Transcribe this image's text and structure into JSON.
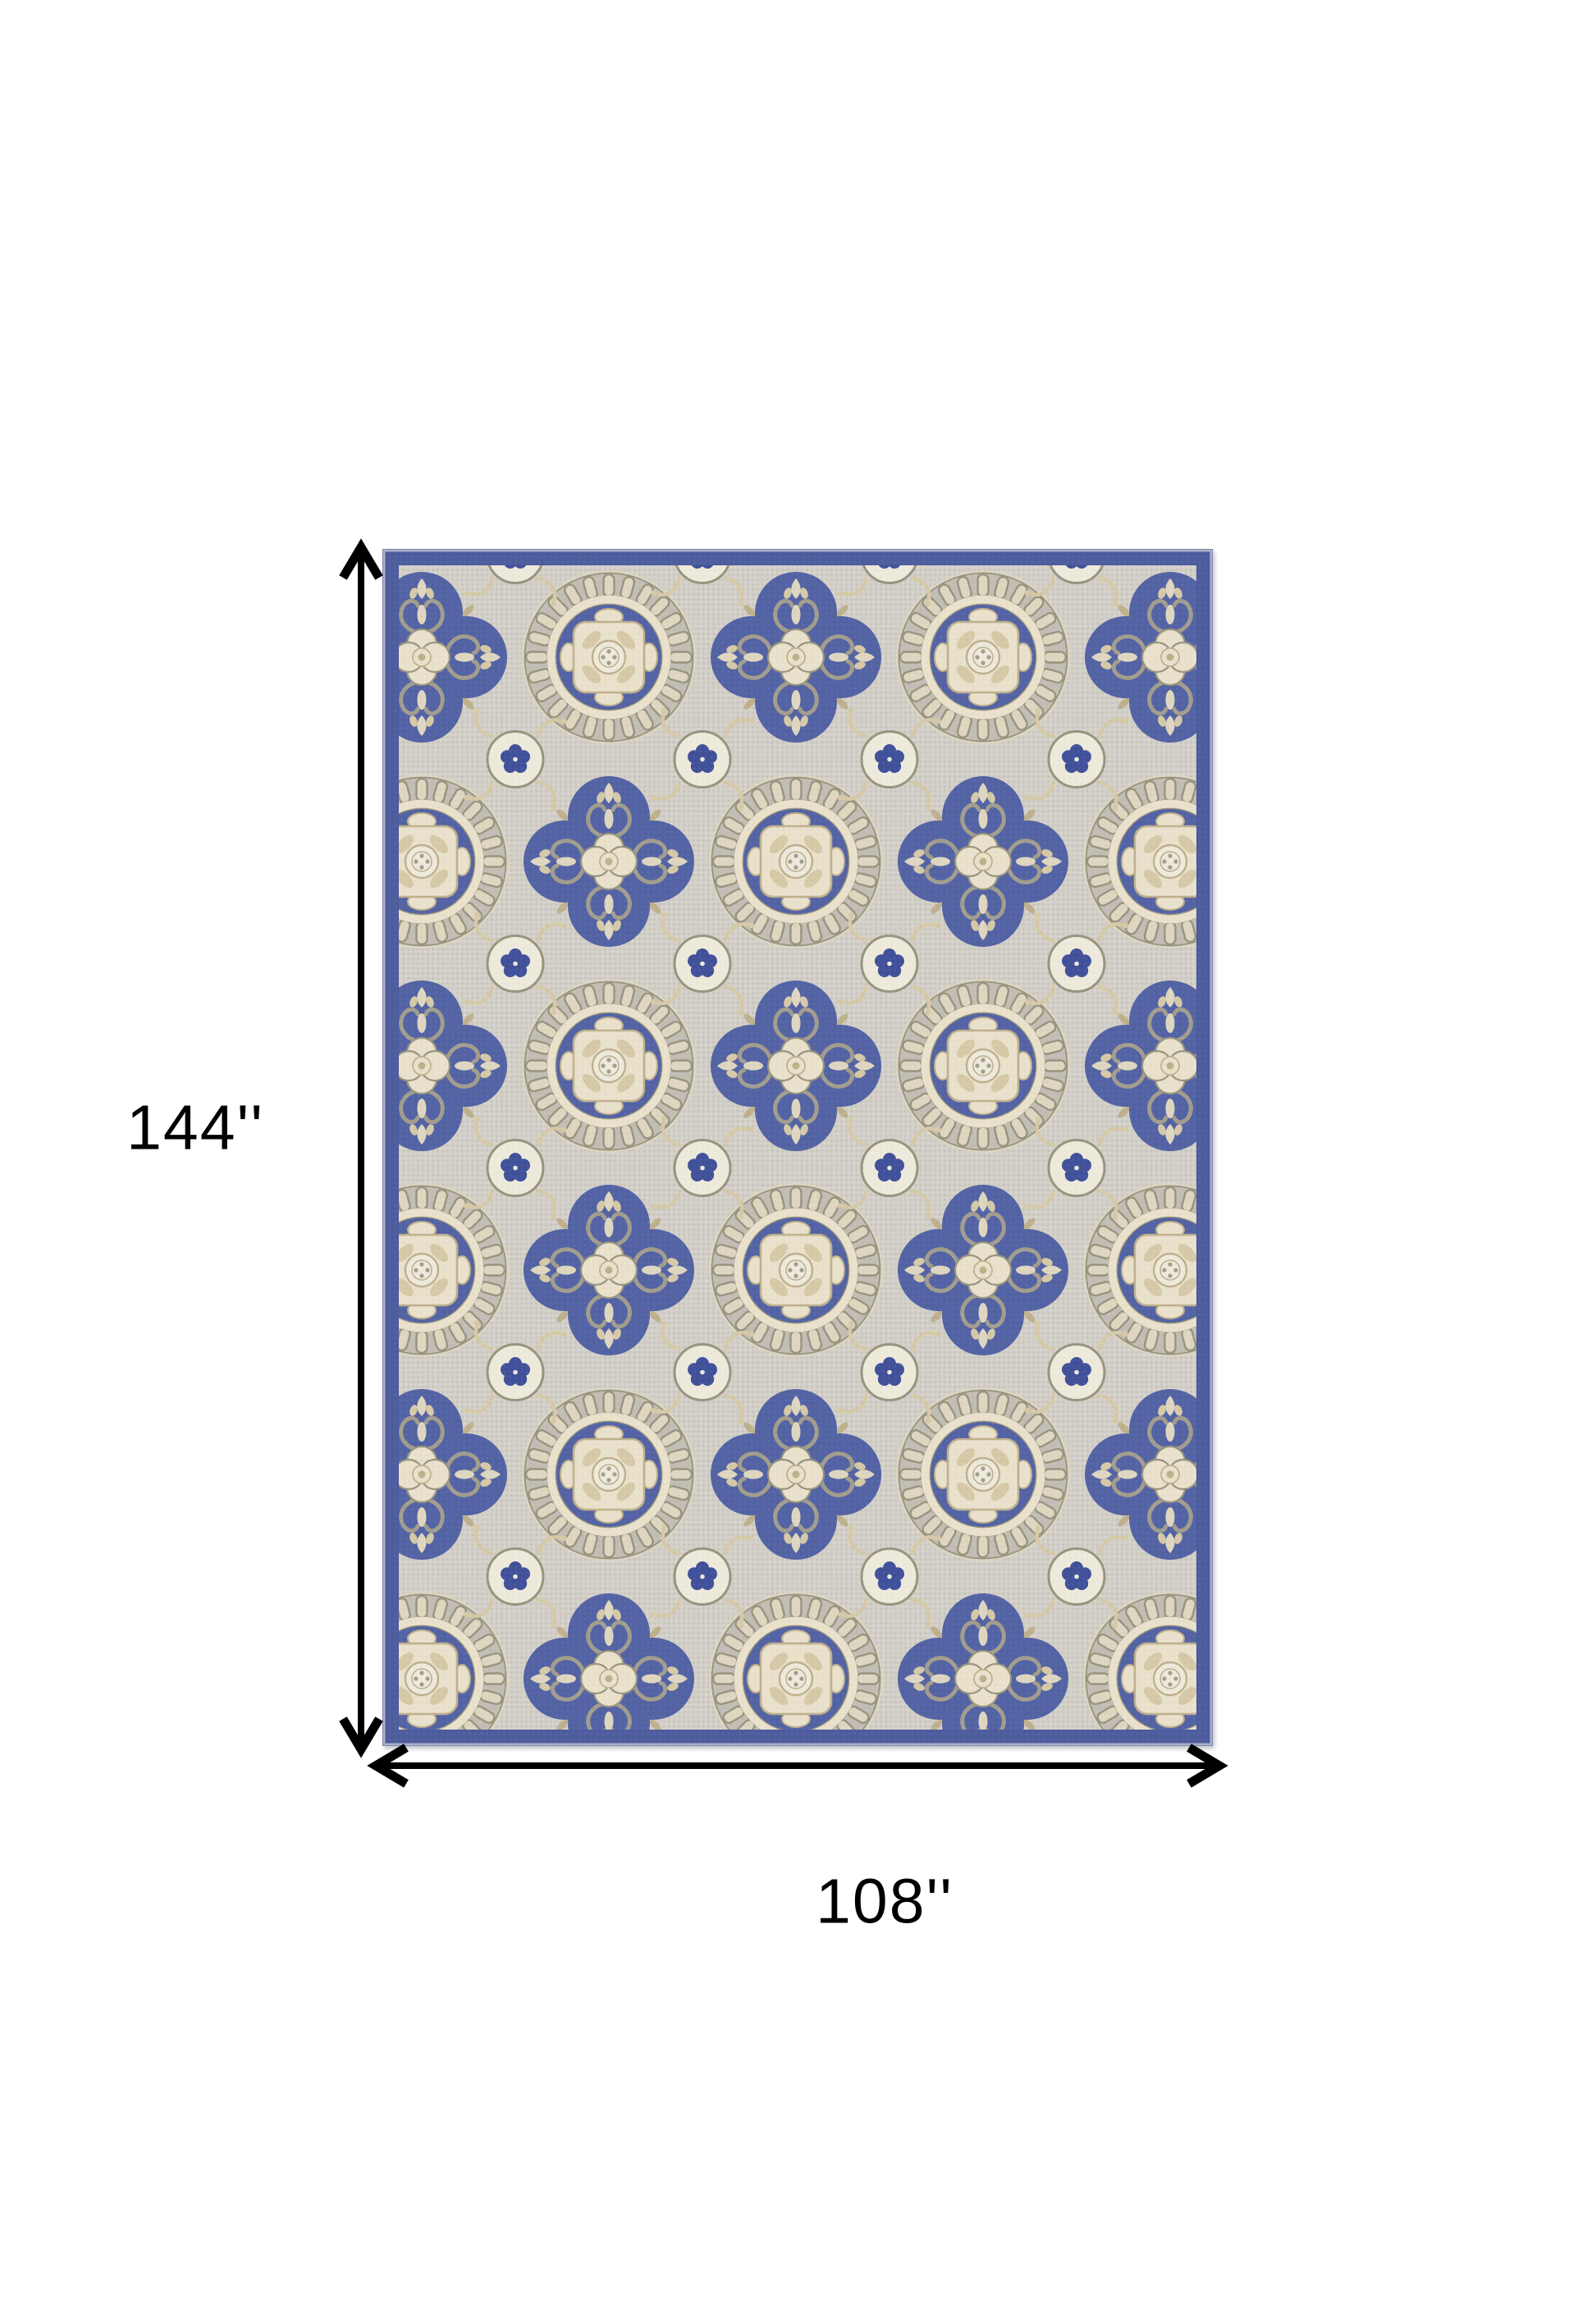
{
  "page": {
    "background": "#ffffff"
  },
  "diagram": {
    "type": "product-dimension-diagram",
    "subject": "medallion-area-rug",
    "height_label": "144''",
    "width_label": "108''"
  },
  "icons": {
    "vertical_arrow": "double-headed-arrow-vertical",
    "horizontal_arrow": "double-headed-arrow-horizontal"
  },
  "colors": {
    "arrow_black": "#000000",
    "label_text": "#000000",
    "border_blue": "#4d5d9e",
    "motif_blue": "#5363a4",
    "flower_blue": "#41519a",
    "field_grey": "#d2cfc8",
    "field_dot": "#c2beb5",
    "field_dot_light": "#dcd9d2",
    "cream_light": "#e9e1cb",
    "cream_ring": "#ded6c0",
    "beige": "#d6c9a7",
    "beige_dark": "#bfb08d",
    "taupe": "#a29d8e",
    "taupe_outline": "#98947f",
    "white_circle": "#edeadc",
    "rug_edge_line": "#c3c6cd"
  }
}
